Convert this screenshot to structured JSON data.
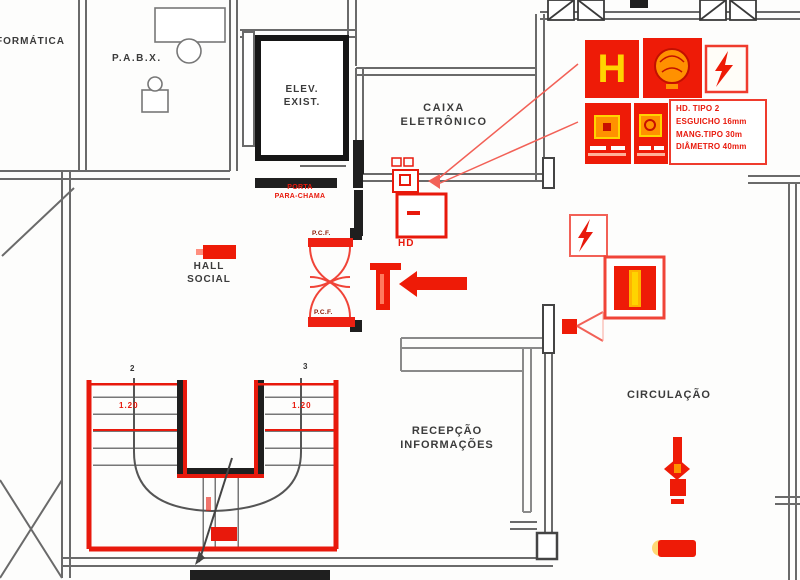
{
  "plan": {
    "rooms": {
      "informatica": "INFORMÁTICA",
      "pabx": "P.A.B.X.",
      "elev_line1": "ELEV.",
      "elev_line2": "EXIST.",
      "caixa_line1": "CAIXA",
      "caixa_line2": "ELETRÔNICO",
      "hall_line1": "HALL",
      "hall_line2": "SOCIAL",
      "recepcao_line1": "RECEPÇÃO",
      "recepcao_line2": "INFORMAÇÕES",
      "circulacao": "CIRCULAÇÃO"
    },
    "fire_annotations": {
      "porta_line1": "PORTA",
      "porta_line2": "PARA-CHAMA",
      "pcf_top": "P.C.F.",
      "pcf_bottom": "P.C.F.",
      "hd_label": "HD"
    },
    "stairs": {
      "dim_left": "1.20",
      "dim_right": "1.20",
      "num_left": "2",
      "num_right": "3"
    },
    "legend": {
      "h_letter": "H",
      "spec_line1": "HD. TIPO 2",
      "spec_line2": "ESGUICHO 16mm",
      "spec_line3": "MANG.TIPO 30m",
      "spec_line4": "DIÂMETRO 40mm",
      "icons": [
        "hydrant-legend-icon",
        "fire-alarm-bell-icon",
        "electrical-hazard-icon",
        "manual-call-point-icon",
        "siren-icon"
      ]
    },
    "symbols": [
      "electrical-panel-icon",
      "fire-extinguisher-icon",
      "hydrant-riser-icon",
      "exit-arrow-icon",
      "direction-triangle-icon",
      "fire-door-swing"
    ],
    "colors": {
      "red": "#ee1b07",
      "yellow": "#ffd400",
      "orange": "#ff9100",
      "wall_gray": "#6a6a6a",
      "wall_dark": "#1f1f1f"
    }
  }
}
